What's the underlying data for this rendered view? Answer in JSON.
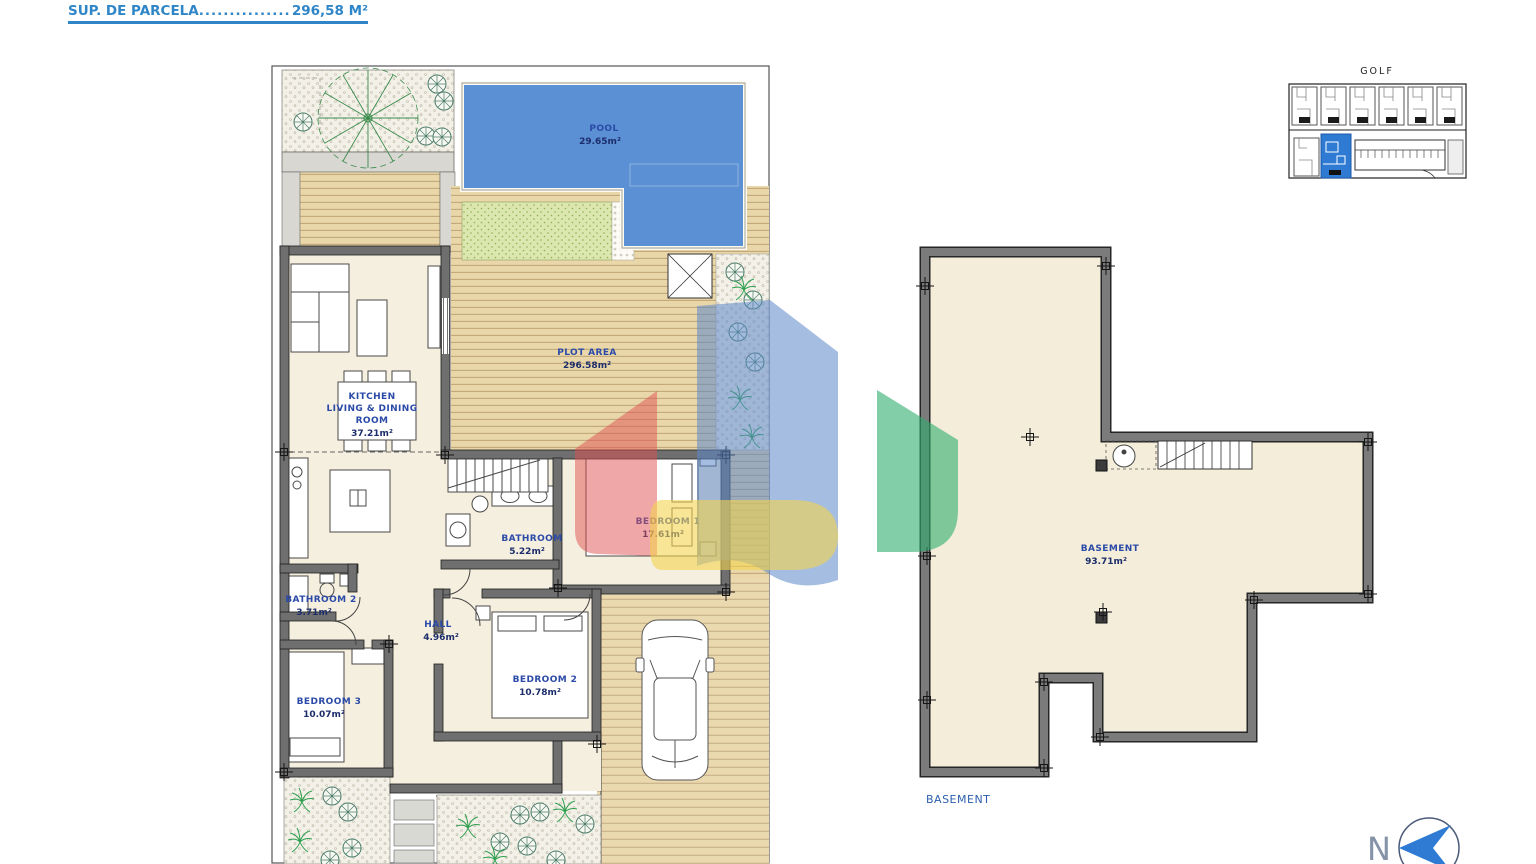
{
  "header": {
    "line1": "PLOT AREA/",
    "line2_label": "SUP. DE PARCELA",
    "line2_dots": "..............................",
    "line2_value": "296,58 M²"
  },
  "ground_floor": {
    "pool_name": "POOL",
    "pool_area": "29.65m²",
    "plot_name": "PLOT AREA",
    "plot_area": "296.58m²",
    "kitchen_line1": "KITCHEN",
    "kitchen_line2": "LIVING & DINING",
    "kitchen_line3": "ROOM",
    "kitchen_area": "37.21m²",
    "bathroom1_name": "BATHROOM",
    "bathroom1_area": "5.22m²",
    "bedroom1_name": "BEDROOM 1",
    "bedroom1_area": "17.61m²",
    "bathroom2_name": "BATHROOM 2",
    "bathroom2_area": "3.71m²",
    "hall_name": "HALL",
    "hall_area": "4.96m²",
    "bedroom2_name": "BEDROOM 2",
    "bedroom2_area": "10.78m²",
    "bedroom3_name": "BEDROOM 3",
    "bedroom3_area": "10.07m²"
  },
  "basement": {
    "name": "BASEMENT",
    "area": "93.71m²",
    "caption": "BASEMENT"
  },
  "site_inset": {
    "title": "GOLF"
  },
  "compass": {
    "letter": "N"
  },
  "colors": {
    "header_blue": "#2e86c8",
    "label_blue": "#2b4aa8",
    "pool_blue": "#5b90d4",
    "highlight_unit_blue": "#2f7bd4",
    "north_arrow_blue": "#2f7bd4",
    "watermark_red": "#e05050",
    "watermark_blue": "#5b86c8",
    "watermark_yellow": "#f3d44e",
    "watermark_green": "#2fae6e",
    "wall_gray": "#6f6f6f",
    "deck_beige": "#e9d7aa",
    "floor_beige": "#f5efdf"
  }
}
